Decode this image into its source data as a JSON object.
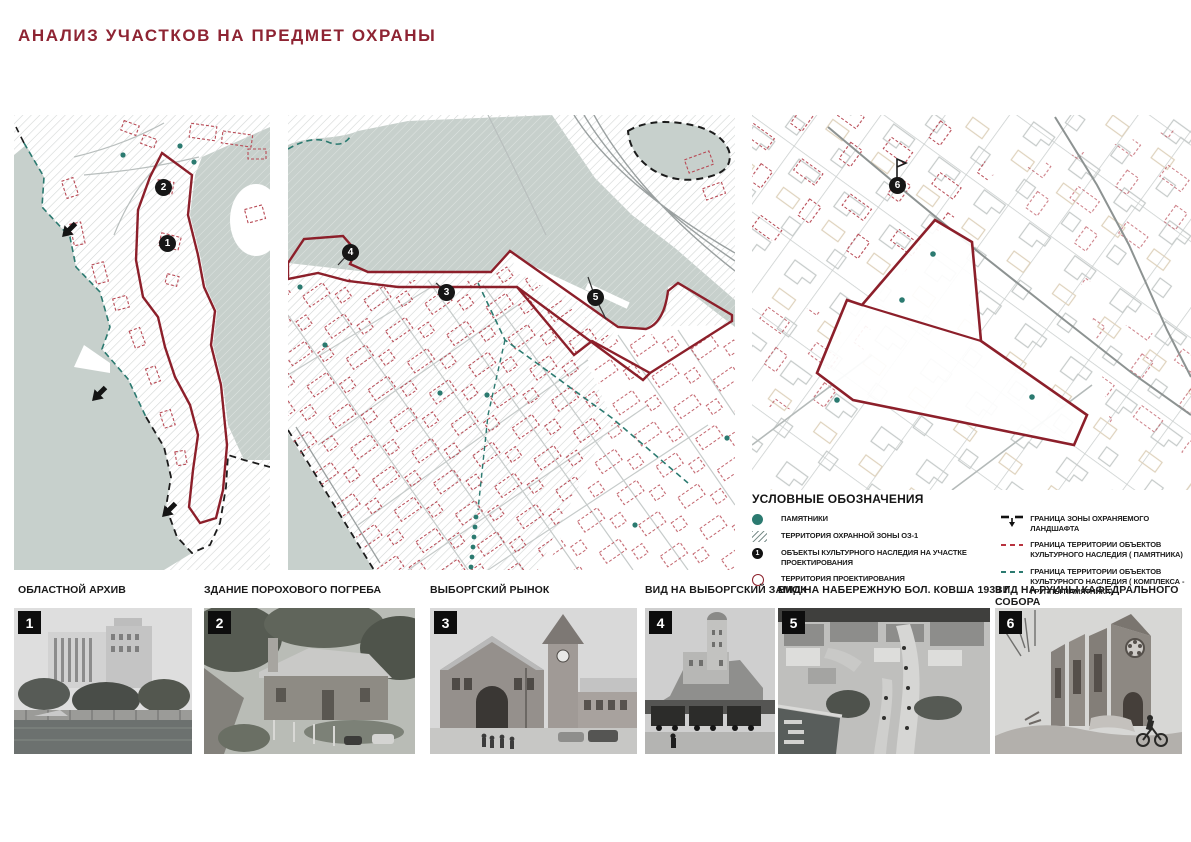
{
  "page": {
    "title": "АНАЛИЗ УЧАСТКОВ НА ПРЕДМЕТ ОХРАНЫ"
  },
  "colors": {
    "title_maroon": "#8e2433",
    "boundary_red": "#8c1f2a",
    "building_dashed_red": "#b84a55",
    "monument_teal": "#2b7a70",
    "water_gray_green": "#c7d0cc",
    "badge_black": "#0d0d0d"
  },
  "maps": {
    "panel1": {
      "markers": [
        {
          "n": "1"
        },
        {
          "n": "2"
        }
      ]
    },
    "panel2": {
      "markers": [
        {
          "n": "3"
        },
        {
          "n": "4"
        },
        {
          "n": "5"
        }
      ]
    },
    "panel3": {
      "markers": [
        {
          "n": "6"
        }
      ]
    }
  },
  "legend": {
    "title": "УСЛОВНЫЕ ОБОЗНАЧЕНИЯ",
    "left": [
      {
        "symbol": "monument-dot",
        "label": "ПАМЯТНИКИ"
      },
      {
        "symbol": "hatch-swatch",
        "label": "ТЕРРИТОРИЯ ОХРАННОЙ ЗОНЫ  ОЗ-1"
      },
      {
        "symbol": "numbered-dot",
        "symbol_number": "1",
        "label": "ОБЪЕКТЫ КУЛЬТУРНОГО НАСЛЕДИЯ НА УЧАСТКЕ ПРОЕКТИРОВАНИЯ"
      },
      {
        "symbol": "open-circle",
        "label": "ТЕРРИТОРИЯ ПРОЕКТИРОВАНИЯ"
      }
    ],
    "right": [
      {
        "symbol": "landscape-boundary",
        "label": "ГРАНИЦА ЗОНЫ ОХРАНЯЕМОГО ЛАНДШАФТА"
      },
      {
        "symbol": "red-dashed-line",
        "label": "ГРАНИЦА ТЕРРИТОРИИ ОБЪЕКТОВ КУЛЬТУРНОГО НАСЛЕДИЯ ( ПАМЯТНИКА)"
      },
      {
        "symbol": "teal-dashed-line",
        "label": "ГРАНИЦА ТЕРРИТОРИИ ОБЪЕКТОВ КУЛЬТУРНОГО НАСЛЕДИЯ ( КОМПЛЕКСА - ГРУППЫ ПАМЯТНИКА)"
      }
    ]
  },
  "photos": [
    {
      "number": "1",
      "caption": "ОБЛАСТНОЙ  АРХИВ"
    },
    {
      "number": "2",
      "caption": "ЗДАНИЕ ПОРОХОВОГО ПОГРЕБА"
    },
    {
      "number": "3",
      "caption": "ВЫБОРГСКИЙ РЫНОК"
    },
    {
      "number": "4",
      "caption": "ВИД НА ВЫБОРГСКИЙ ЗАМОК"
    },
    {
      "number": "5",
      "caption": "ВИД  НА  НАБЕРЕЖНУЮ БОЛ. КОВША 1939 Г"
    },
    {
      "number": "6",
      "caption": "ВИД  НА  РУИНЫ КАФЕДРАЛЬНОГО СОБОРА"
    }
  ]
}
